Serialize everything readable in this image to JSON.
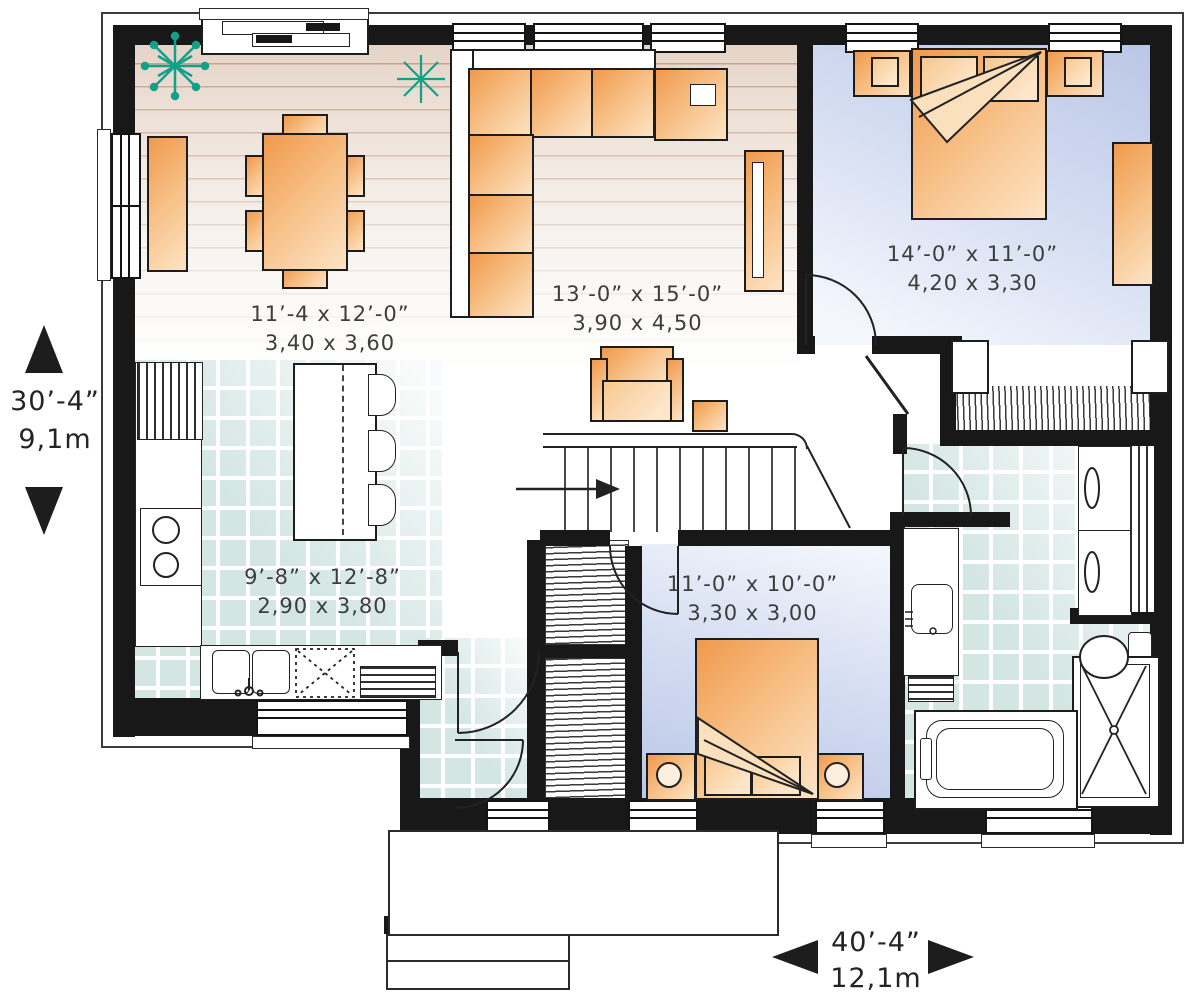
{
  "floor_plan": {
    "rooms": {
      "dining": {
        "imperial": "11’-4 x 12’-0”",
        "metric": "3,40 x 3,60"
      },
      "living": {
        "imperial": "13’-0” x 15’-0”",
        "metric": "3,90 x 4,50"
      },
      "master_bedroom": {
        "imperial": "14’-0” x 11’-0”",
        "metric": "4,20 x 3,30"
      },
      "kitchen": {
        "imperial": "9’-8” x 12’-8”",
        "metric": "2,90 x 3,80"
      },
      "bedroom_2": {
        "imperial": "11’-0” x 10’-0”",
        "metric": "3,30 x 3,00"
      }
    },
    "overall_dimensions": {
      "depth_imperial": "30’-4”",
      "depth_metric": "9,1m",
      "width_imperial": "40’-4”",
      "width_metric": "12,1m"
    },
    "colors": {
      "wall": "#181818",
      "furniture_orange": "#f09a4c",
      "plant_green": "#12a188",
      "tile_teal": "#d3e6e2",
      "bedroom_blue": "#b9c6e6",
      "wood_beige": "#e5d3c6"
    },
    "icons": {
      "plant": "teal starburst",
      "stairs_direction": "right arrow",
      "depth_markers": "up/down solid triangles",
      "width_markers": "left/right solid triangles"
    }
  }
}
